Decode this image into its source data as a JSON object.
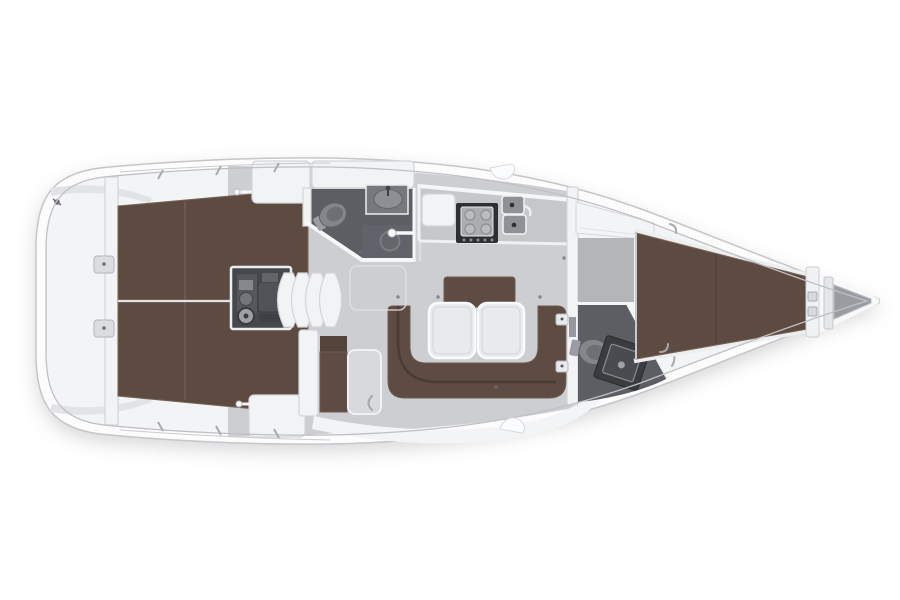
{
  "meta": {
    "subject": "sailing-yacht-interior-floor-plan",
    "orientation": "bow-right-stern-left",
    "visible_text": ""
  },
  "colors": {
    "hull_fill": "#fcfcfd",
    "hull_stroke": "#c5c6ca",
    "deck_line": "#bfc0c5",
    "floor": "#cdced2",
    "white_zone": "#f3f4f6",
    "furniture_white": "#f2f3f5",
    "furniture_stroke": "#d4d5d8",
    "berth": "#5d4b42",
    "berth_edge": "#7a6456",
    "sofa": "#5e4b43",
    "sofa_edge": "#6f5a4e",
    "sofa_seam": "#44362e",
    "table": "#e9eaec",
    "table_edge": "#d4d5d8",
    "head_floor": "#5c5e64",
    "wall_white": "#f5f6f8",
    "fixture": "#84868c",
    "fixture_edge": "#5e6066",
    "fixture_dark": "#6d6f75",
    "fixture_light": "#9a9ca1",
    "engine_box": "#45474c",
    "stove_frame": "#2e2f32",
    "stove_top": "#abadb1",
    "sink": "#8f9196",
    "metal": "#a6a8ac",
    "dot": "#6e7075"
  },
  "features": [
    {
      "id": "hull",
      "label": "hull outline"
    },
    {
      "id": "transom-platform",
      "label": "stern transom platform"
    },
    {
      "id": "aft-berth",
      "label": "aft double berths"
    },
    {
      "id": "engine-compartment",
      "label": "engine compartment"
    },
    {
      "id": "companionway-steps",
      "label": "companionway steps"
    },
    {
      "id": "aft-head",
      "label": "aft head with toilet, sink and shower"
    },
    {
      "id": "galley",
      "label": "galley with stove and twin sinks"
    },
    {
      "id": "saloon-settee",
      "label": "U-shaped saloon settee"
    },
    {
      "id": "saloon-tables",
      "label": "twin saloon tables"
    },
    {
      "id": "forward-head",
      "label": "forward head with toilet and vanity"
    },
    {
      "id": "forward-cabin-berth",
      "label": "forward cabin V-berth"
    },
    {
      "id": "anchor-locker",
      "label": "bow anchor locker"
    }
  ]
}
